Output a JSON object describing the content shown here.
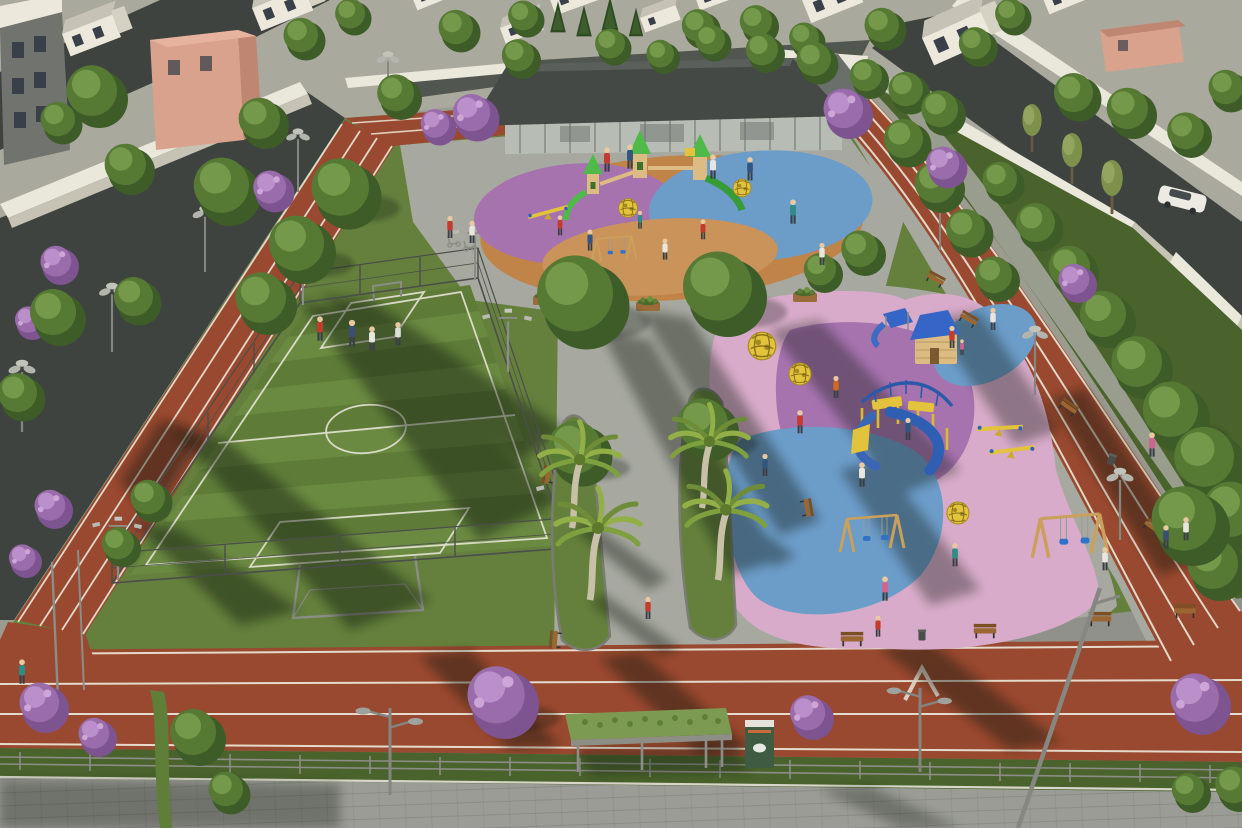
{
  "meta": {
    "type": "3d-architectural-render",
    "view": "aerial-perspective",
    "subject": "urban neighborhood park design visualization"
  },
  "scene": {
    "elements": [
      "residential-houses",
      "salmon-apartment-building",
      "boundary-walls",
      "asphalt-streets",
      "running-track-loop",
      "soccer-field",
      "field-fence",
      "floodlights",
      "glass-pavilion-cafe",
      "entrance-plaza",
      "toddler-playground-castle",
      "kids-playground-slides",
      "swing-sets",
      "climbing-spheres",
      "playhouse-cabin",
      "seesaws",
      "central-walkway",
      "palm-trees",
      "green-medians",
      "benches",
      "trash-bins",
      "street-sidewalk",
      "guard-railing",
      "green-roof-bus-shelter",
      "kiosk",
      "street-lamps",
      "white-car",
      "cyclist",
      "pedestrians",
      "deciduous-trees",
      "purple-flowering-trees",
      "conifers"
    ]
  },
  "palette": {
    "cityBase": "#9b9b90",
    "lotLight": "#aaa99d",
    "asphalt": "#3e433f",
    "asphaltLight": "#515651",
    "wall": "#eae7db",
    "wallShade": "#c6c3b5",
    "houseFront": "#ece9dc",
    "houseSide": "#d6d2c3",
    "roofLight": "#c6c3b6",
    "roofDark": "#5d615e",
    "winDark": "#39404a",
    "salmon": "#d9a28c",
    "salmonShade": "#bf8671",
    "grass": "#64803c",
    "grassDark": "#4a632c",
    "grassLight": "#79944a",
    "fieldA": "#5e7c38",
    "fieldB": "#6b8a41",
    "pave": "#a7a8a0",
    "paveShade": "#90918a",
    "sidewalk": "#9c9c96",
    "track": "#99492f",
    "trackDark": "#7c3a26",
    "lane": "#ece7d9",
    "fence": "#4b4e4a",
    "metal": "#8b8d86",
    "roofPav": "#454946",
    "glass": "#b7bcb4",
    "purple": "#9b6cab",
    "purpleLight": "#bb8fc9",
    "purpleDark": "#7d5490",
    "palmGreen": "#93af48",
    "palmDark": "#6f8c38",
    "palmTrunk": "#c9c0a8",
    "playPink": "#d7abc9",
    "playMauve": "#a673af",
    "playBlue": "#6c9cc8",
    "playOrange": "#c08348",
    "sand": "#c9935a",
    "equipGreen": "#4fba4a",
    "equipGreenDark": "#379b36",
    "equipYellow": "#e3c33c",
    "equipBlue": "#2f62b4",
    "cabinWood": "#dcbc82",
    "wood": "#9a6632",
    "woodDark": "#7c4f24",
    "carWhite": "#eceae3",
    "skin": "#e9c9a2",
    "shadow": "#0e140b"
  }
}
